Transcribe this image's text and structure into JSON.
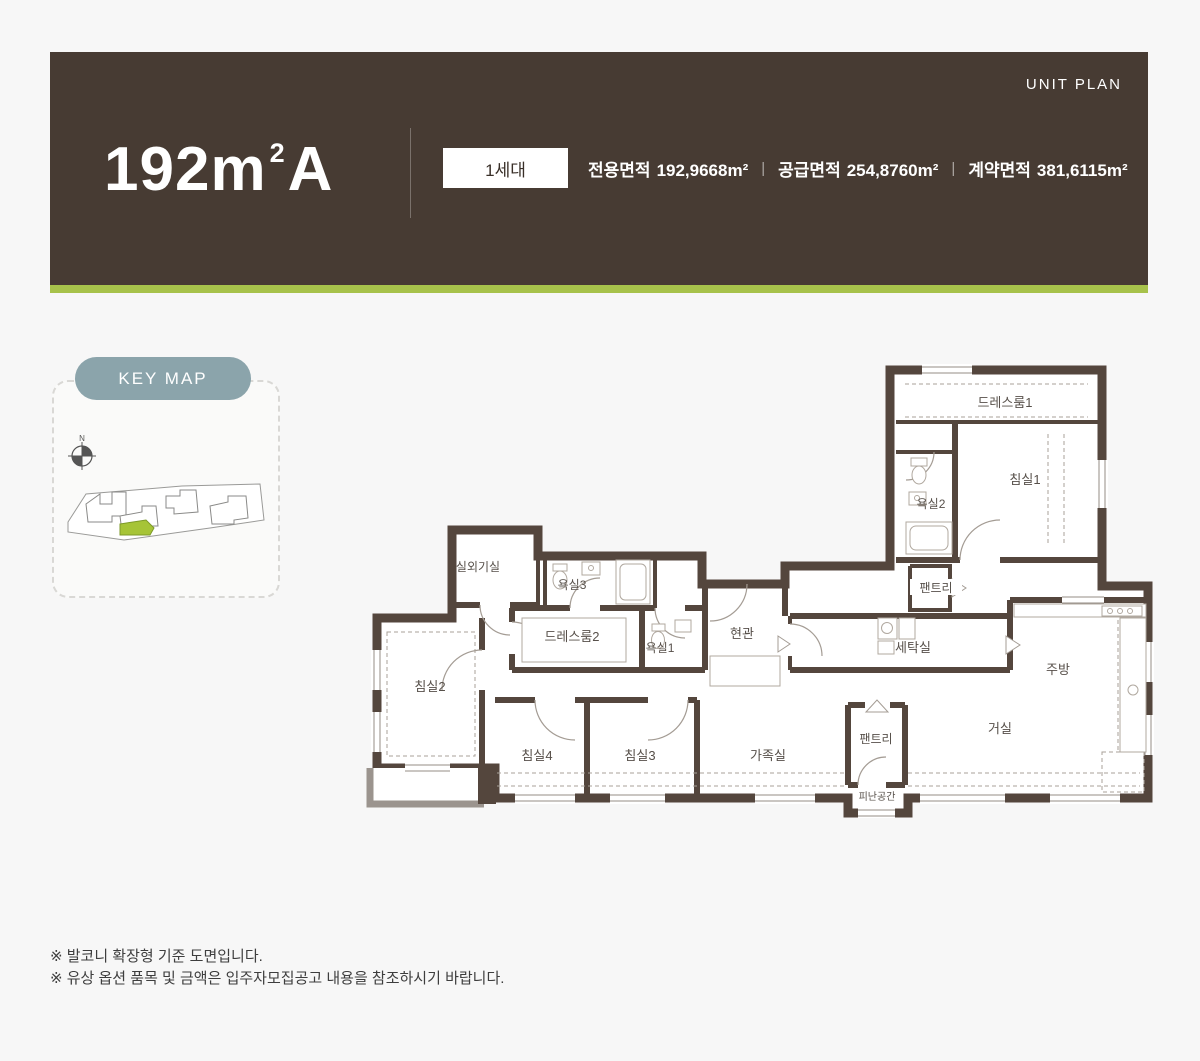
{
  "header": {
    "unit_plan_label": "UNIT PLAN",
    "title_main": "192m",
    "title_sup": "2",
    "title_suffix": "A",
    "badge": "1세대",
    "separator": "|",
    "areas": [
      {
        "label": "전용면적",
        "value": "192,9668m²"
      },
      {
        "label": "공급면적",
        "value": "254,8760m²"
      },
      {
        "label": "계약면적",
        "value": "381,6115m²"
      }
    ],
    "colors": {
      "background": "#473b33",
      "accent_bar": "#a7c24b"
    }
  },
  "keymap": {
    "badge_label": "KEY MAP",
    "north_label": "N",
    "badge_color": "#8ba4ab",
    "highlight_color": "#a6c437"
  },
  "floorplan": {
    "wall_color": "#54463d",
    "rooms": [
      {
        "id": "dressroom1",
        "label": "드레스룸1"
      },
      {
        "id": "bedroom1",
        "label": "침실1"
      },
      {
        "id": "bath2",
        "label": "욕실2"
      },
      {
        "id": "pantry-upper",
        "label": "팬트리"
      },
      {
        "id": "laundry",
        "label": "세탁실"
      },
      {
        "id": "kitchen",
        "label": "주방"
      },
      {
        "id": "entry",
        "label": "현관"
      },
      {
        "id": "bath1",
        "label": "욕실1"
      },
      {
        "id": "dressroom2",
        "label": "드레스룸2"
      },
      {
        "id": "bath3",
        "label": "욕실3"
      },
      {
        "id": "outdoor-unit",
        "label": "실외기실"
      },
      {
        "id": "bedroom2",
        "label": "침실2"
      },
      {
        "id": "bedroom4",
        "label": "침실4"
      },
      {
        "id": "bedroom3",
        "label": "침실3"
      },
      {
        "id": "family",
        "label": "가족실"
      },
      {
        "id": "pantry-lower",
        "label": "팬트리"
      },
      {
        "id": "living",
        "label": "거실"
      },
      {
        "id": "refuge",
        "label": "피난공간"
      }
    ]
  },
  "notes": [
    "※ 발코니 확장형 기준 도면입니다.",
    "※ 유상 옵션 품목 및 금액은 입주자모집공고 내용을 참조하시기 바랍니다."
  ]
}
